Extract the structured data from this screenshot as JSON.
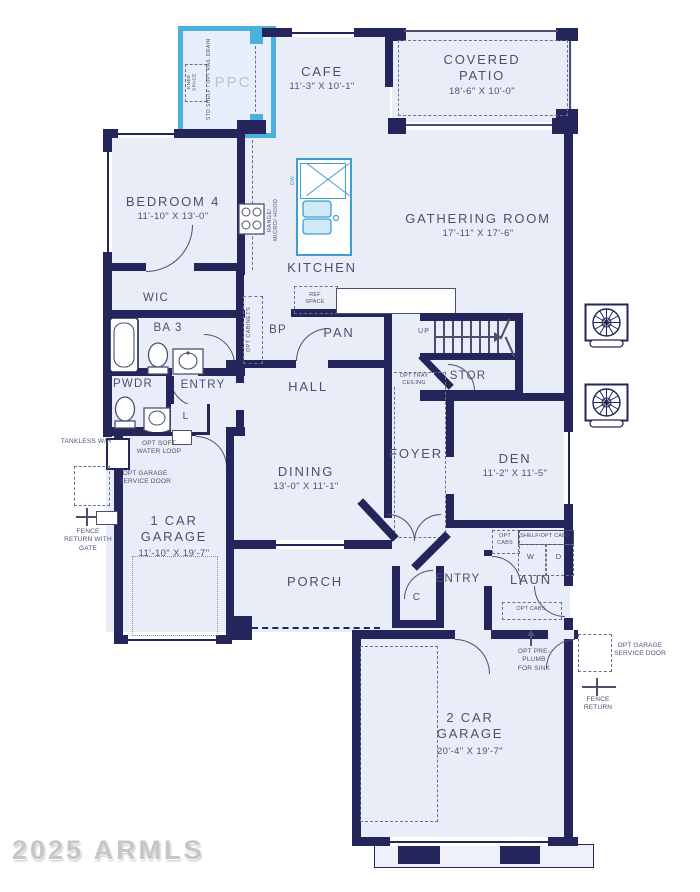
{
  "watermark": "2025 ARMLS",
  "rooms": {
    "ppc": {
      "label": "PPC"
    },
    "cafe": {
      "label": "CAFE",
      "dims": "11'-3\" X 10'-1\""
    },
    "covered_patio": {
      "label": "COVERED PATIO",
      "dims": "18'-6\" X 10'-0\""
    },
    "bedroom4": {
      "label": "BEDROOM 4",
      "dims": "11'-10\" X 13'-0\""
    },
    "kitchen": {
      "label": "KITCHEN"
    },
    "gathering": {
      "label": "GATHERING ROOM",
      "dims": "17'-11\" X 17'-6\""
    },
    "wic": {
      "label": "WIC"
    },
    "ba3": {
      "label": "BA 3"
    },
    "pwdr": {
      "label": "PWDR"
    },
    "entry_upper": {
      "label": "ENTRY"
    },
    "linen": {
      "label": "L"
    },
    "bp": {
      "label": "BP"
    },
    "pan": {
      "label": "PAN"
    },
    "hall": {
      "label": "HALL"
    },
    "stor": {
      "label": "STOR"
    },
    "foyer": {
      "label": "FOYER"
    },
    "den": {
      "label": "DEN",
      "dims": "11'-2\" X 11'-5\""
    },
    "dining": {
      "label": "DINING",
      "dims": "13'-0\" X 11'-1\""
    },
    "garage1": {
      "label": "1 CAR GARAGE",
      "dims": "11'-10\" X 19'-7\""
    },
    "porch": {
      "label": "PORCH"
    },
    "entry_lower": {
      "label": "ENTRY"
    },
    "coat": {
      "label": "C"
    },
    "laun": {
      "label": "LAUN"
    },
    "garage2": {
      "label": "2 CAR GARAGE",
      "dims": "20'-4\" X 19'-7\""
    }
  },
  "ann": {
    "knee_space": "KNEE SPACE",
    "std_shelf": "STD SHELF / OPT RAIL DRAIN",
    "ref_space": "REF SPACE",
    "opt_cabinets": "OPT CABINETS",
    "range_micro_hood": "RANGE/ MICRO/ HOOD",
    "dw": "DW",
    "up": "UP",
    "opt_tray_ceiling": "OPT TRAY CEILING",
    "tankless_wh": "TANKLESS W/H",
    "opt_soft_water_loop": "OPT SOFT WATER LOOP",
    "opt_garage_service_door_left": "OPT GARAGE SERVICE DOOR",
    "fence_return_with_gate": "FENCE RETURN WITH GATE",
    "opt_cabs_upper": "OPT CABS",
    "shelf_opt_cabs": "SHELF/OPT CABS",
    "washer": "W",
    "dryer": "D",
    "opt_cabs_lower": "OPT CABS",
    "opt_preplumb": "OPT PRE-PLUMB FOR SINK",
    "opt_garage_service_door_right": "OPT GARAGE SERVICE DOOR",
    "fence_return_right": "FENCE RETURN"
  },
  "colors": {
    "wall": "#23255b",
    "room_fill": "#e9edf8",
    "accent_blue": "#4cb0df",
    "accent_fill": "#cfe9f6",
    "text": "#4b5070",
    "watermark": "#c6c6c6"
  }
}
